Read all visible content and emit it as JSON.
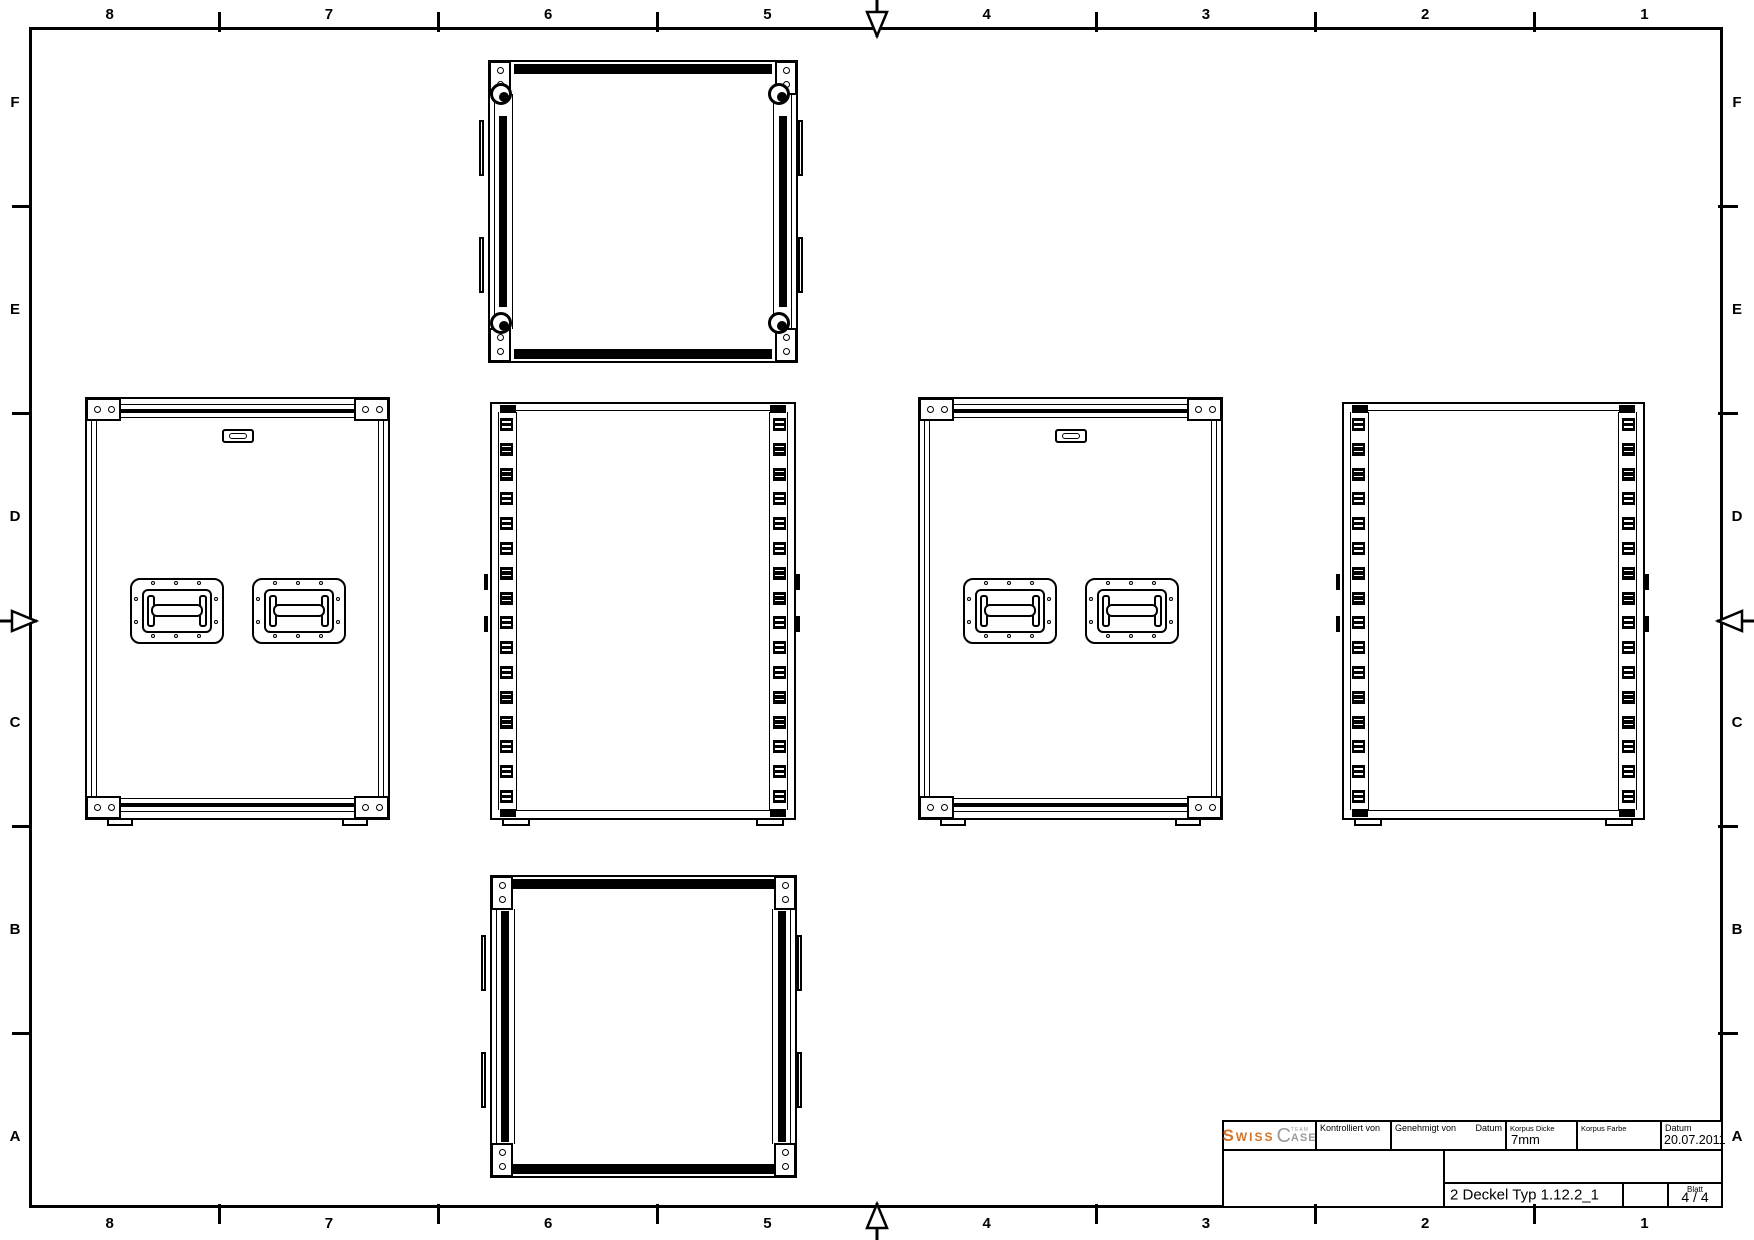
{
  "sheet": {
    "background": "#ffffff",
    "line_color": "#000000",
    "border_grid": {
      "column_labels": [
        "8",
        "7",
        "6",
        "5",
        "4",
        "3",
        "2",
        "1"
      ],
      "row_labels": [
        "F",
        "E",
        "D",
        "C",
        "B",
        "A"
      ]
    }
  },
  "title_block": {
    "logo": {
      "s_big": "S",
      "s_rest": "WISS",
      "c_big": "C",
      "team": "TEAM",
      "ase": "ASE",
      "orange": "#d2752b",
      "gray": "#9b9b9b"
    },
    "kontrolliert_label": "Kontrolliert von",
    "genehmigt_label": "Genehmigt von",
    "genehmigt_datum_label": "Datum",
    "korpus_dicke_label": "Korpus Dicke",
    "korpus_dicke_value": "7mm",
    "korpus_farbe_label": "Korpus Farbe",
    "datum_label": "Datum",
    "datum_value": "20.07.2011",
    "drawing_title": "2 Deckel Typ 1.12.2_1",
    "blatt_label": "Blatt",
    "blatt_value": "4 / 4"
  },
  "views": [
    {
      "id": "lid-top",
      "type": "lid",
      "x": 488,
      "y": 60,
      "w": 310,
      "h": 303,
      "ball_corners": true,
      "hinges_per_side": 2
    },
    {
      "id": "front-left",
      "type": "front",
      "x": 85,
      "y": 397,
      "w": 305,
      "h": 423,
      "handles": 2
    },
    {
      "id": "side-center",
      "type": "side",
      "x": 490,
      "y": 402,
      "w": 306,
      "h": 418,
      "rivets_per_rail": 16
    },
    {
      "id": "front-right",
      "type": "front",
      "x": 918,
      "y": 397,
      "w": 305,
      "h": 423,
      "handles": 2
    },
    {
      "id": "side-right",
      "type": "side",
      "x": 1342,
      "y": 402,
      "w": 303,
      "h": 418,
      "rivets_per_rail": 16
    },
    {
      "id": "lid-bottom",
      "type": "lid",
      "x": 490,
      "y": 875,
      "w": 307,
      "h": 303,
      "ball_corners": false,
      "hinges_per_side": 2
    }
  ]
}
